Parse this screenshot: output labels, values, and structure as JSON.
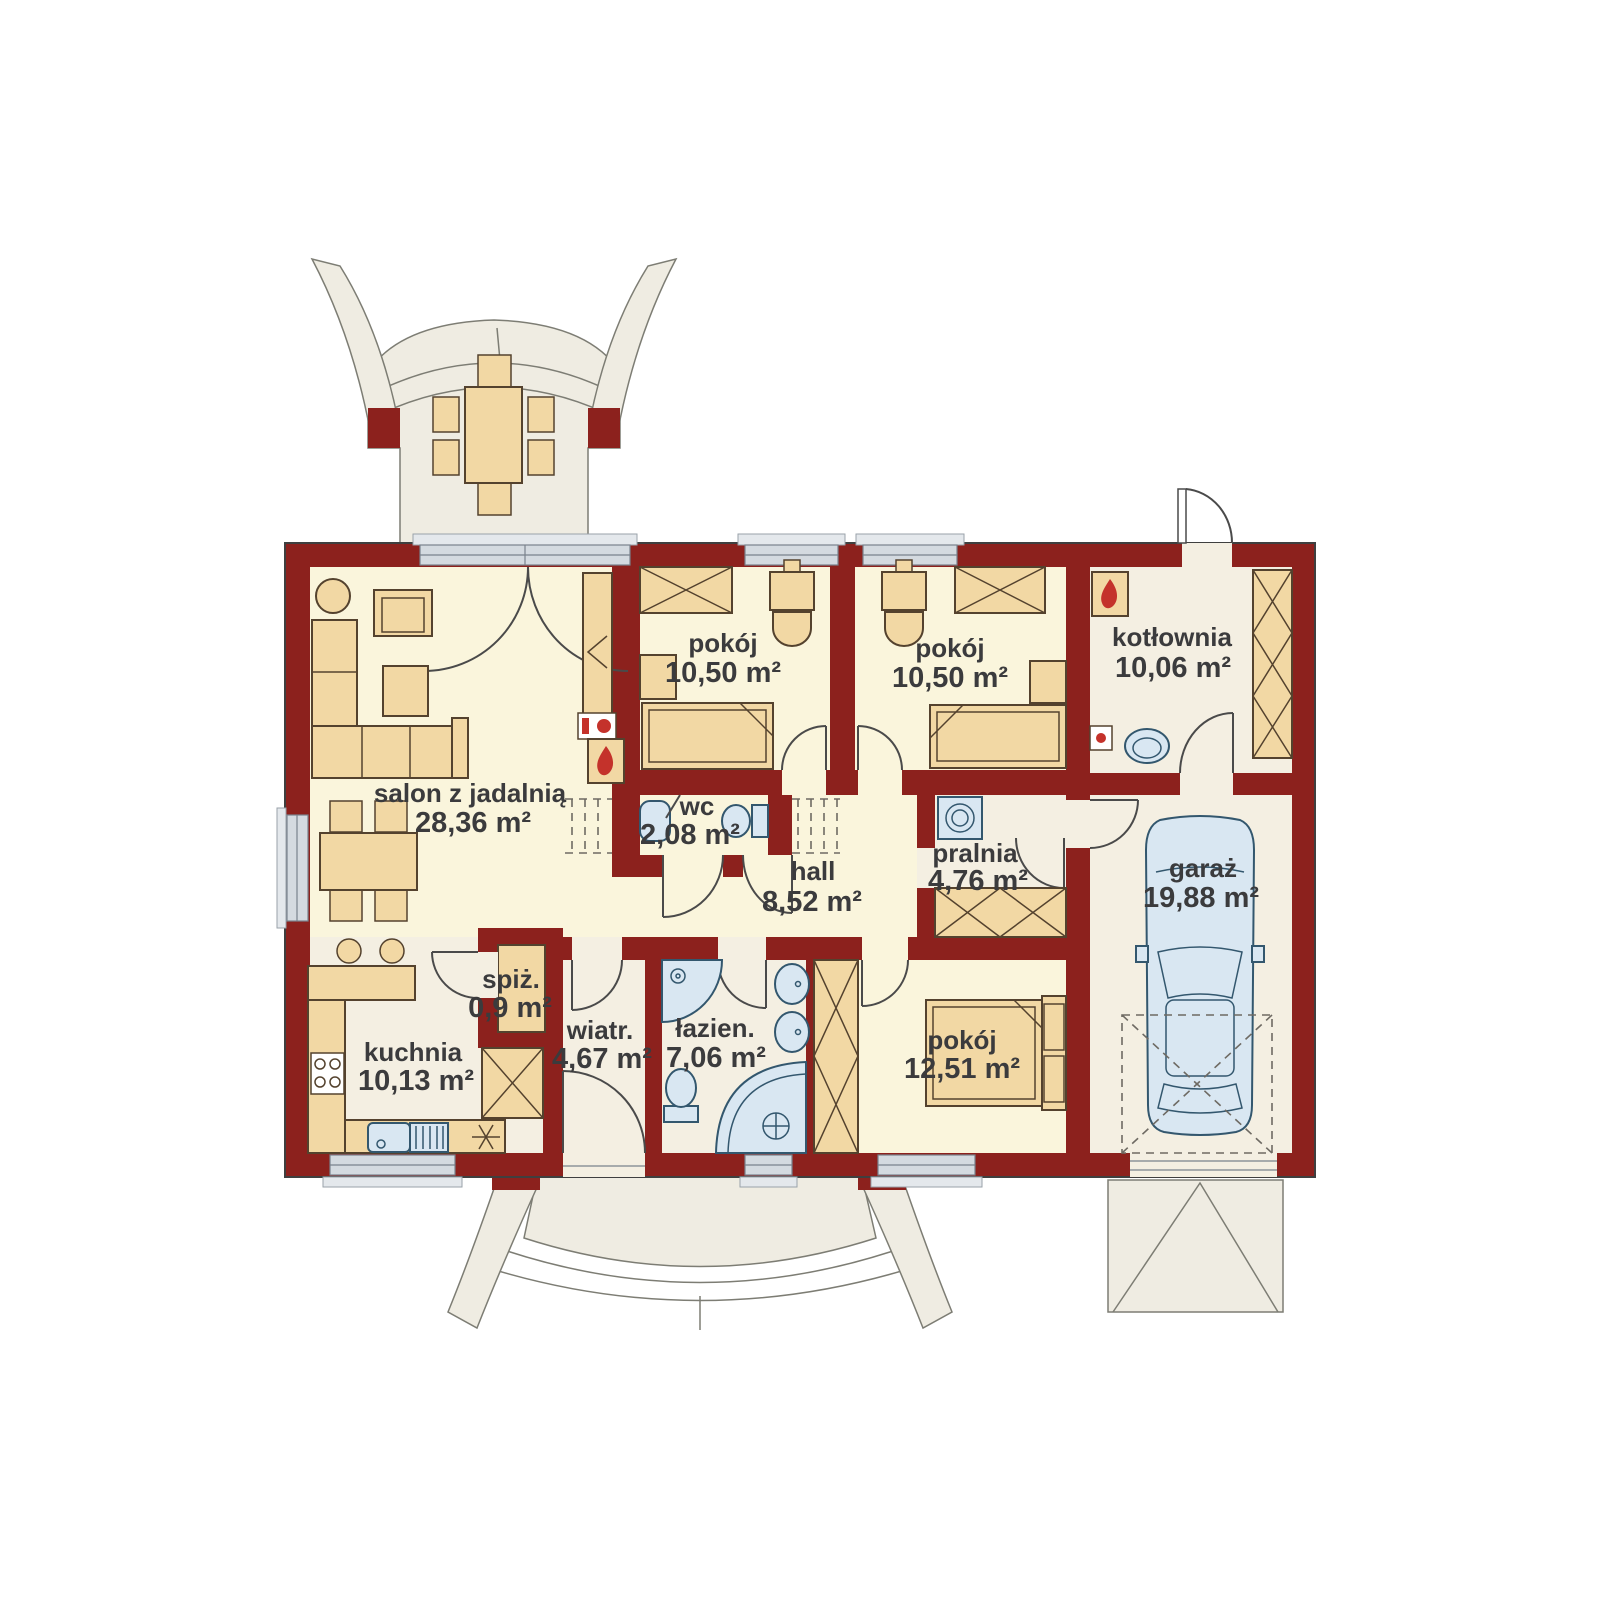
{
  "floor_plan": {
    "rooms": [
      {
        "id": "salon",
        "label": "salon z jadalnią",
        "area": "28,36 m²"
      },
      {
        "id": "pokoj-1",
        "label": "pokój",
        "area": "10,50 m²"
      },
      {
        "id": "pokoj-2",
        "label": "pokój",
        "area": "10,50 m²"
      },
      {
        "id": "kotlownia",
        "label": "kotłownia",
        "area": "10,06 m²"
      },
      {
        "id": "wc",
        "label": "wc",
        "area": "2,08 m²"
      },
      {
        "id": "hall",
        "label": "hall",
        "area": "8,52 m²"
      },
      {
        "id": "pralnia",
        "label": "pralnia",
        "area": "4,76 m²"
      },
      {
        "id": "garaz",
        "label": "garaż",
        "area": "19,88 m²"
      },
      {
        "id": "spiz",
        "label": "spiż.",
        "area": "0,9 m²"
      },
      {
        "id": "kuchnia",
        "label": "kuchnia",
        "area": "10,13 m²"
      },
      {
        "id": "wiatr",
        "label": "wiatr.",
        "area": "4,67 m²"
      },
      {
        "id": "lazienka",
        "label": "łazien.",
        "area": "7,06 m²"
      },
      {
        "id": "pokoj-3",
        "label": "pokój",
        "area": "12,51 m²"
      }
    ],
    "colors": {
      "wall": "#8C211D",
      "floor_warm": "#FAF5DC",
      "floor_cool": "#F4EFE2",
      "outdoor": "#EFECE2",
      "furniture": "#F2D8A4",
      "fixture": "#D9E7F2",
      "window_glass": "#D4DAE0",
      "flame_red": "#C4322B",
      "text": "#3B3B3D"
    }
  }
}
